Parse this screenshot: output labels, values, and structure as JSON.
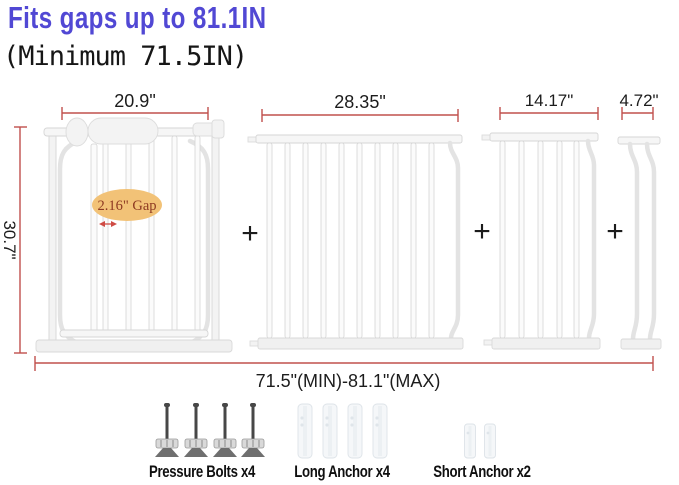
{
  "header": {
    "title": "Fits gaps up to 81.1IN",
    "subtitle": "(Minimum 71.5IN)"
  },
  "diagram": {
    "height_label": "30.7\"",
    "total_label": "71.5\"(MIN)-81.1\"(MAX)",
    "gap_label": "2.16\" Gap",
    "plus": "+",
    "panels": [
      {
        "name": "main-gate",
        "width_label": "20.9\""
      },
      {
        "name": "extension-28in",
        "width_label": "28.35\""
      },
      {
        "name": "extension-14in",
        "width_label": "14.17\""
      },
      {
        "name": "extension-4in",
        "width_label": "4.72\""
      }
    ]
  },
  "legend": {
    "items": [
      {
        "icon": "pressure-bolt-icon",
        "label": "Pressure Bolts x4"
      },
      {
        "icon": "long-anchor-icon",
        "label": "Long Anchor x4"
      },
      {
        "icon": "short-anchor-icon",
        "label": "Short Anchor x2"
      }
    ]
  },
  "colors": {
    "title": "#5148d4",
    "dimension_line": "#c0504d",
    "gap_fill": "#f2c277",
    "gap_text": "#8d3a22"
  }
}
